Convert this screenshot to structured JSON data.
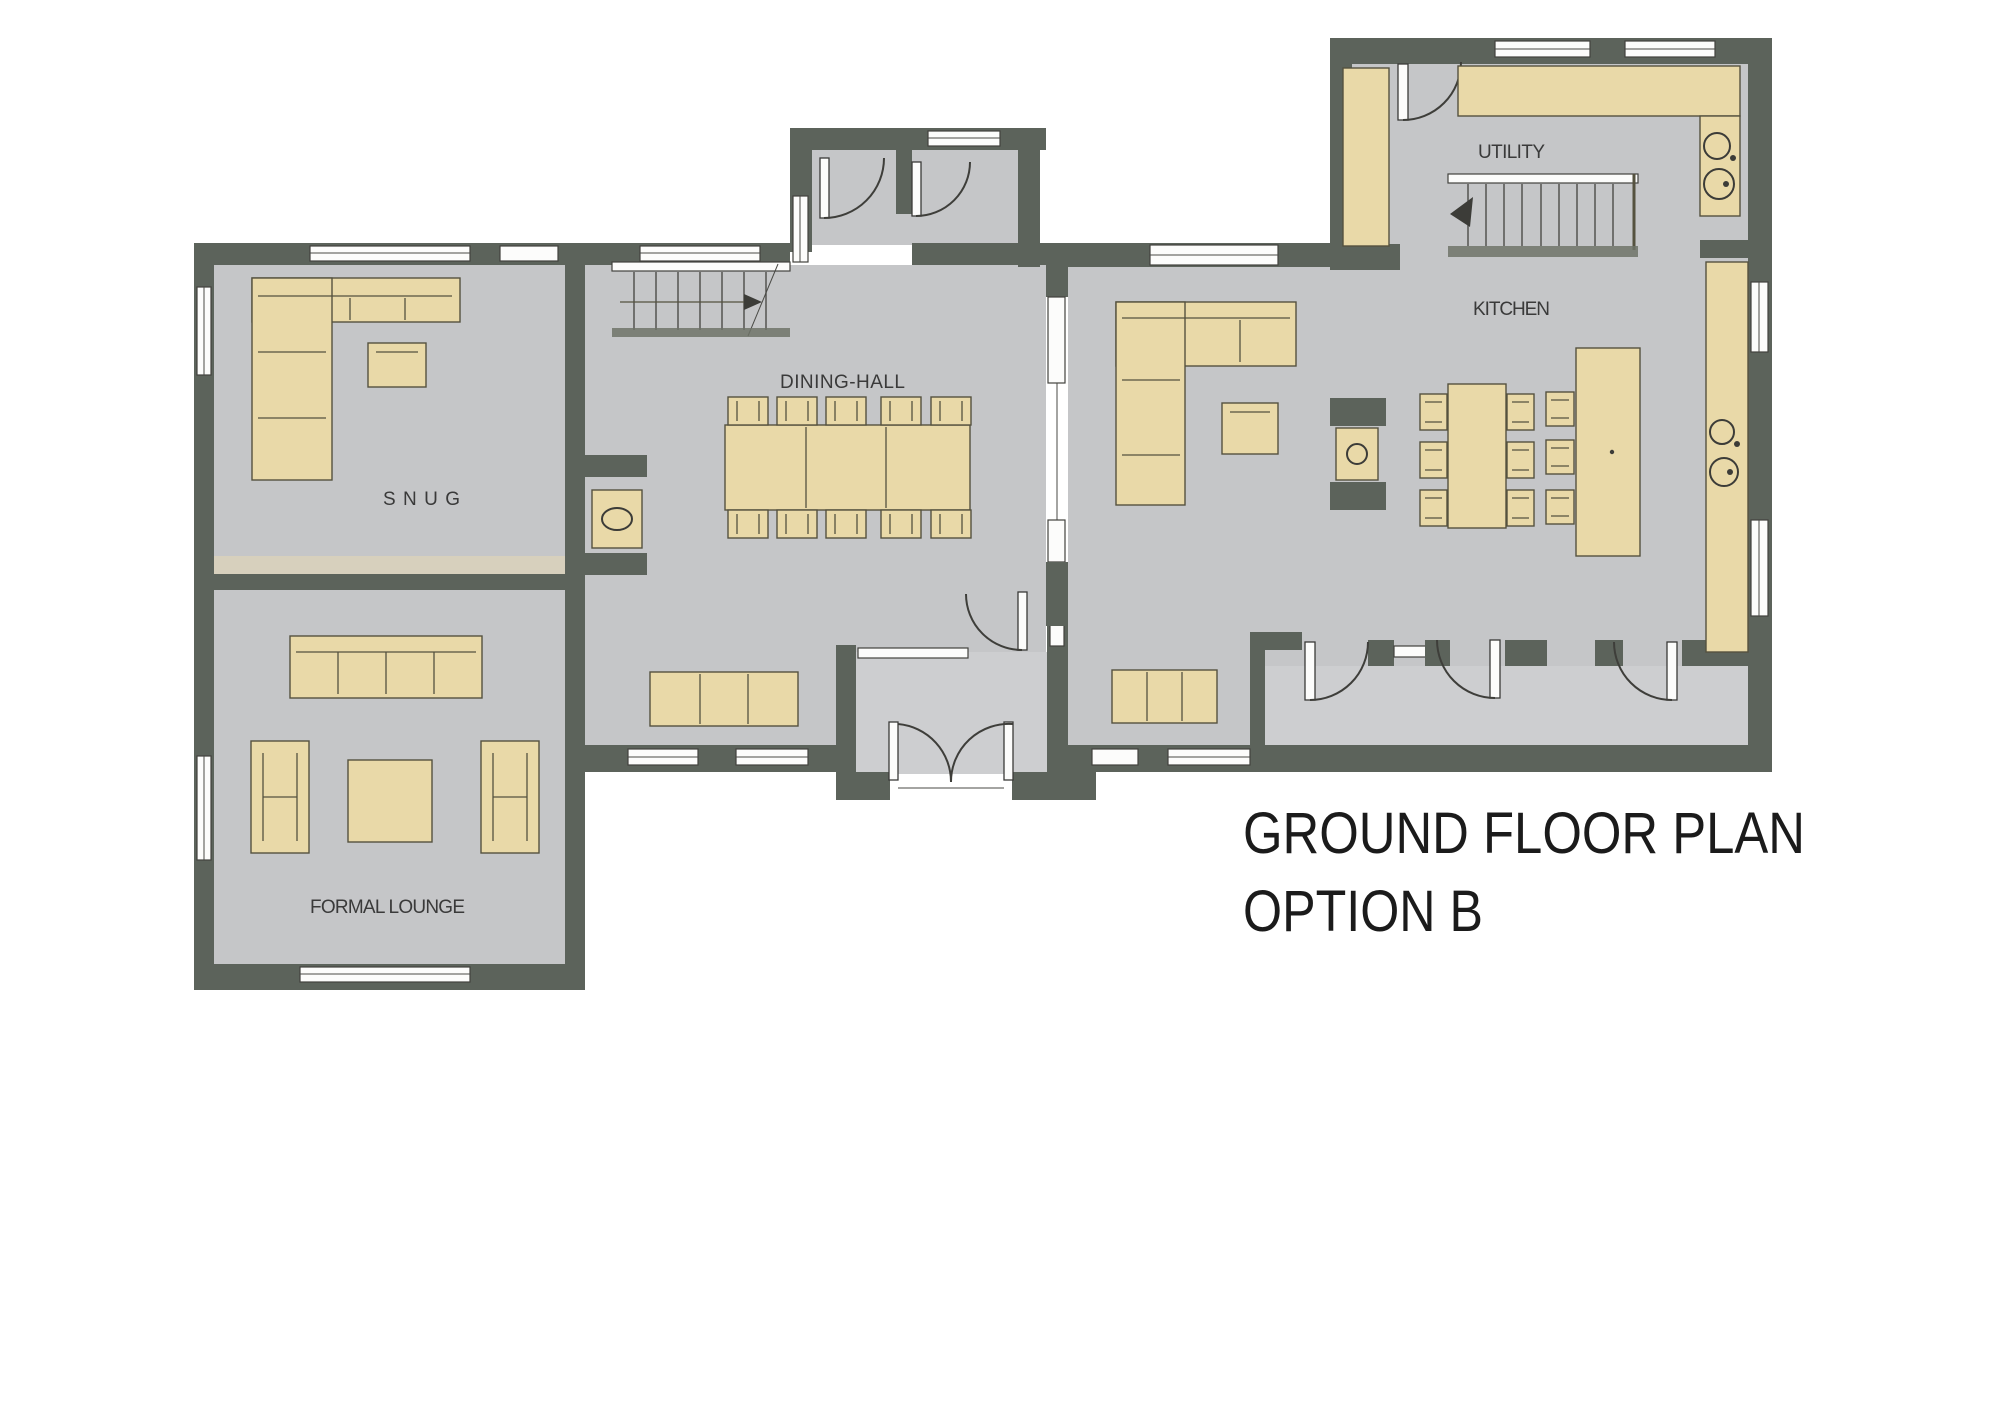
{
  "title": {
    "line1": "GROUND FLOOR PLAN",
    "line2": "OPTION B"
  },
  "rooms": {
    "snug": "SNUG",
    "formal_lounge": "FORMAL LOUNGE",
    "dining_hall": "DINING-HALL",
    "kitchen": "KITCHEN",
    "utility": "UTILITY"
  },
  "colors": {
    "background": "#ffffff",
    "wall": "#5c635b",
    "floor": "#c5c6c8",
    "floor_light": "#cdced0",
    "furniture": "#e9d9a8",
    "furniture_border": "#55523f",
    "step_strip": "#d7d0bd",
    "window_white": "#fcfcfb",
    "line": "#55523f",
    "label_text": "#3a3a3a",
    "title_text": "#1b1b1b"
  }
}
